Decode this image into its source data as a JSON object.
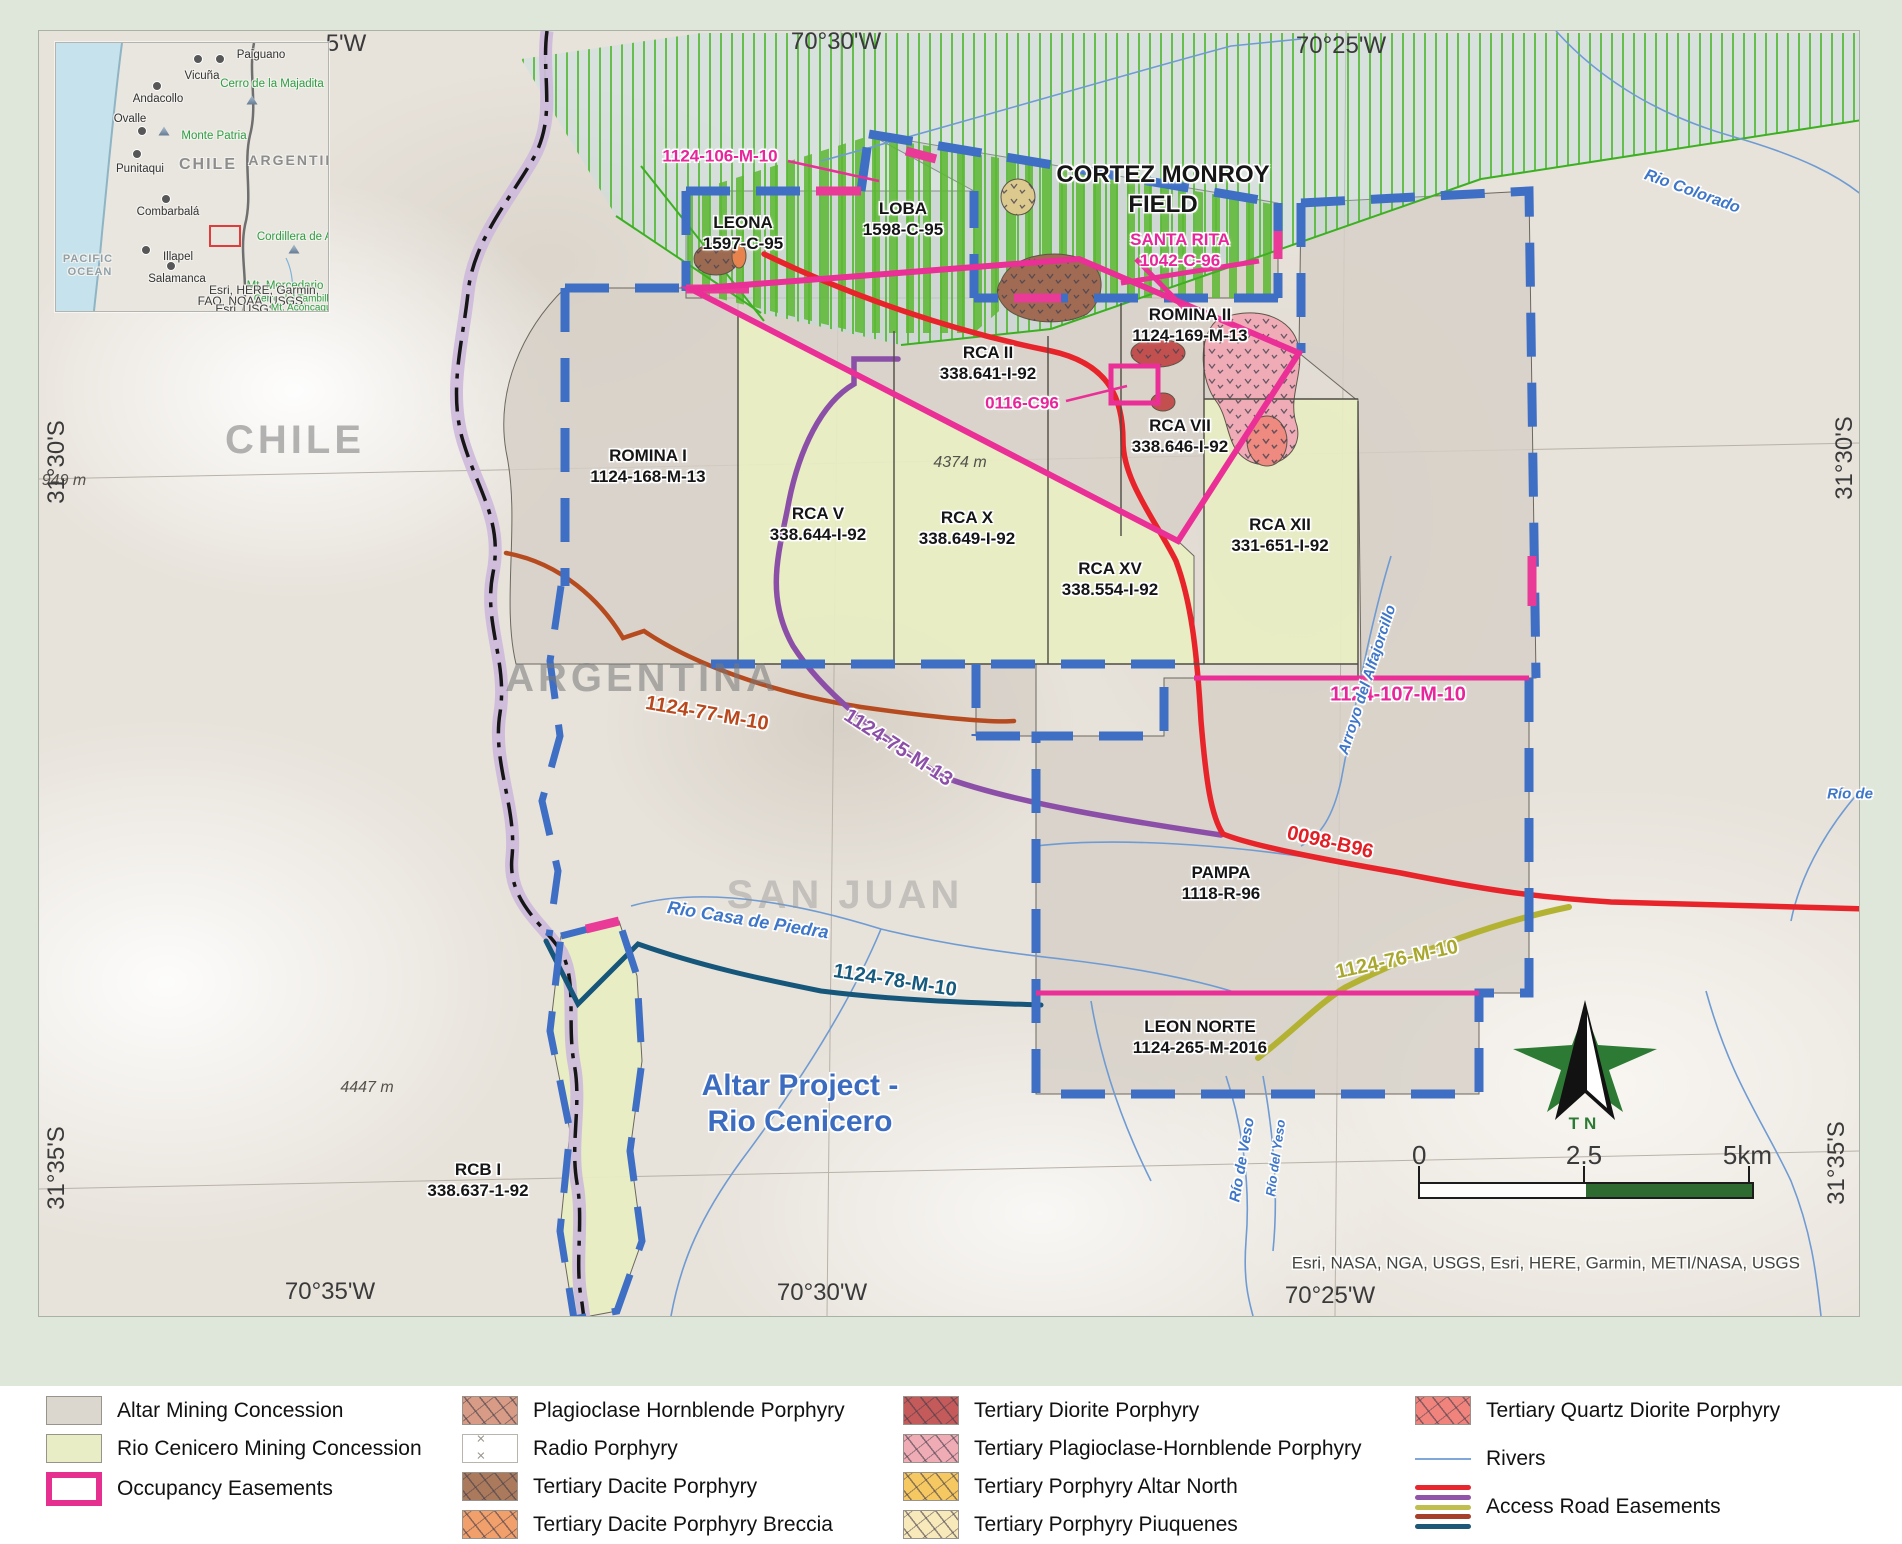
{
  "map": {
    "coords": {
      "top_left": "5'W",
      "top_mid": "70°30'W",
      "top_right": "70°25'W",
      "bottom_left": "70°35'W",
      "bottom_mid": "70°30'W",
      "bottom_right": "70°25'W",
      "left_upper": "31°30'S",
      "left_lower": "31°35'S",
      "right_upper": "31°30'S",
      "right_lower": "31°35'S"
    },
    "labels": {
      "easement_106": "1124-106-M-10",
      "leona_name": "LEONA",
      "leona_code": "1597-C-95",
      "loba_name": "LOBA",
      "loba_code": "1598-C-95",
      "cortez_line1": "CORTEZ MONROY",
      "cortez_line2": "FIELD",
      "santa_rita_name": "SANTA RITA",
      "santa_rita_code": "1042-C-96",
      "rca2_name": "RCA II",
      "rca2_code": "338.641-I-92",
      "easement_0116": "0116-C96",
      "rca7_name": "RCA VII",
      "rca7_code": "338.646-I-92",
      "romina2_name": "ROMINA II",
      "romina2_code": "1124-169-M-13",
      "romina1_name": "ROMINA I",
      "romina1_code": "1124-168-M-13",
      "rca5_name": "RCA V",
      "rca5_code": "338.644-I-92",
      "rca10_name": "RCA X",
      "rca10_code": "338.649-I-92",
      "rca15_name": "RCA XV",
      "rca15_code": "338.554-I-92",
      "rca12_name": "RCA XII",
      "rca12_code": "331-651-I-92",
      "pampa_name": "PAMPA",
      "pampa_code": "1118-R-96",
      "leon_name": "LEON NORTE",
      "leon_code": "1124-265-M-2016",
      "rcb_name": "RCB I",
      "rcb_code": "338.637-1-92",
      "road_77": "1124-77-M-10",
      "road_75": "1124-75-M-13",
      "road_107": "1124-107-M-10",
      "road_0098": "0098-B96",
      "road_76": "1124-76-M-10",
      "road_78": "1124-78-M-10",
      "chile": "CHILE",
      "argentina": "ARGENTINA",
      "san_juan": "SAN JUAN",
      "project_line1": "Altar Project -",
      "project_line2": "Rio Cenicero",
      "rio_colorado": "Rio Colorado",
      "rio_casa": "Rio Casa de Piedra",
      "arroyo": "Arroyo del Alfajorcillo",
      "rio_veso": "Río de Veso",
      "rio_yeso": "Río del Yeso",
      "rio_de": "Río de",
      "elev_4374": "4374 m",
      "elev_4447": "4447 m",
      "elev_949": "949 m"
    },
    "attribution": "Esri, NASA, NGA, USGS, Esri, HERE, Garmin, METI/NASA, USGS"
  },
  "inset": {
    "cities": [
      "Paiguano",
      "Vicuña",
      "Andacollo",
      "Ovalle",
      "Punitaqui",
      "Combarbalá",
      "Illapel",
      "Salamanca"
    ],
    "peaks": [
      "Cerro de la Majadita",
      "Monte Patria",
      "Cordillera de Ansilta",
      "Mt. Mercedario",
      "Cerro del Tambillo",
      "Mt. Aconcagua"
    ],
    "countries": [
      "CHILE",
      "ARGENTINA"
    ],
    "ocean_line1": "PACIFIC",
    "ocean_line2": "OCEAN",
    "attr1": "Esri, HERE, Garmin,",
    "attr2": "FAO, NOAA, USGS,",
    "attr3": "Esri, USGS"
  },
  "scalebar": {
    "t0": "0",
    "t1": "2.5",
    "t2": "5km"
  },
  "north_arrow": {
    "label": "TN"
  },
  "legend": {
    "items": [
      "Altar Mining Concession",
      "Rio Cenicero Mining Concession",
      "Occupancy Easements",
      "Plagioclase Hornblende Porphyry",
      "Radio Porphyry",
      "Tertiary Dacite Porphyry",
      "Tertiary Dacite Porphyry Breccia",
      "Tertiary Diorite Porphyry",
      "Tertiary Plagioclase-Hornblende Porphyry",
      "Tertiary Porphyry Altar North",
      "Tertiary Porphyry Piuquenes",
      "Tertiary Quartz Diorite Porphyry",
      "Rivers",
      "Access Road Easements"
    ],
    "colors": {
      "altar": "#dbd6ce",
      "rio_cenicero": "#e8edc5",
      "occupancy": "#e6308f",
      "blue_boundary": "#3e6fc5",
      "access_roads": [
        "#e8262d",
        "#9055a8",
        "#bfbe4f",
        "#a6402a",
        "#1d5878"
      ],
      "rivers": "#7fa7d9"
    }
  }
}
